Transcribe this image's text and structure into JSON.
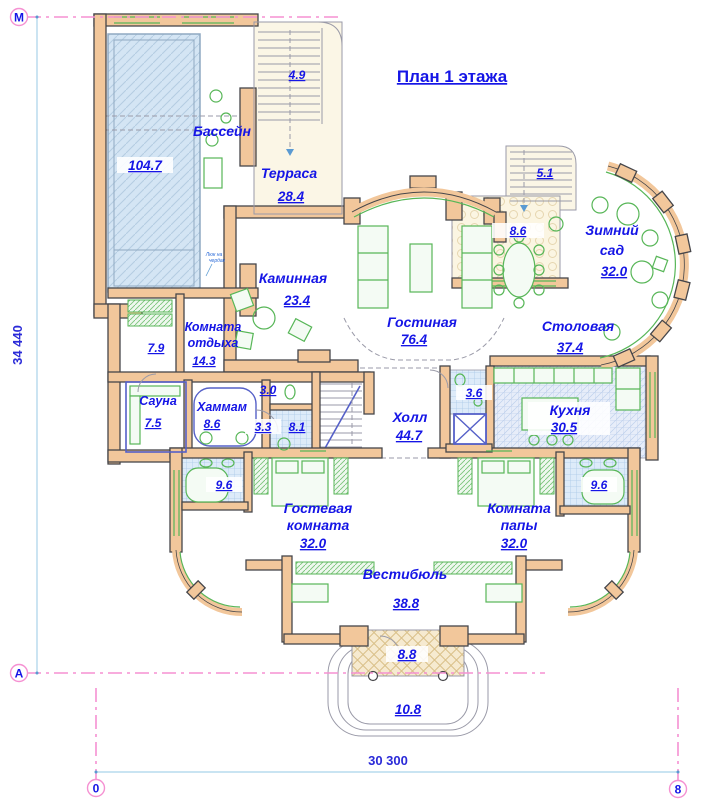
{
  "title": "План 1 этажа",
  "axis_markers": {
    "top_left": "М",
    "mid_left": "А",
    "bottom_left": "0",
    "bottom_right": "8"
  },
  "dimensions": {
    "vertical_total": "34 440",
    "horizontal_total": "30 300"
  },
  "note": {
    "line1": "Люк на",
    "line2": "чердак"
  },
  "rooms": {
    "pool": {
      "name": "Бассейн",
      "area": "104.7"
    },
    "terrace": {
      "name": "Терраса",
      "area": "28.4"
    },
    "stairs_top": {
      "area": "4.9"
    },
    "stairs_right": {
      "area": "5.1"
    },
    "terrace_right": {
      "area": "8.6"
    },
    "winter_garden": {
      "name1": "Зимний",
      "name2": "сад",
      "area": "32.0"
    },
    "fireplace": {
      "name": "Каминная",
      "area": "23.4"
    },
    "living": {
      "name": "Гостиная",
      "area": "76.4"
    },
    "dining": {
      "name": "Столовая",
      "area": "37.4"
    },
    "lounge": {
      "name1": "Комната",
      "name2": "отдыха",
      "area": "14.3"
    },
    "closet": {
      "area": "7.9"
    },
    "sauna": {
      "name": "Сауна",
      "area": "7.5"
    },
    "hammam": {
      "name": "Хаммам",
      "area": "8.6"
    },
    "wc": {
      "area": "3.0"
    },
    "shower": {
      "area": "3.3"
    },
    "stairs_hall": {
      "area": "8.1"
    },
    "hall": {
      "name": "Холл",
      "area": "44.7"
    },
    "bath_hall": {
      "area": "3.6"
    },
    "kitchen": {
      "name": "Кухня",
      "area": "30.5"
    },
    "bath_guest": {
      "area": "9.6"
    },
    "bath_dad": {
      "area": "9.6"
    },
    "guest": {
      "name1": "Гостевая",
      "name2": "комната",
      "area": "32.0"
    },
    "dad": {
      "name1": "Комната",
      "name2": "папы",
      "area": "32.0"
    },
    "vestibule": {
      "name": "Вестибюль",
      "area": "38.8"
    },
    "porch": {
      "area": "8.8"
    },
    "entry_steps": {
      "area": "10.8"
    }
  },
  "colors": {
    "label_blue": "#1515e6",
    "wall_tan": "#f2c79b",
    "axis_pink": "#f591d2",
    "window_green": "#57b657",
    "dimension_blue": "#a9d3e9",
    "pool_water": "#cfe2f2",
    "tile_blue": "#dcebf9"
  }
}
